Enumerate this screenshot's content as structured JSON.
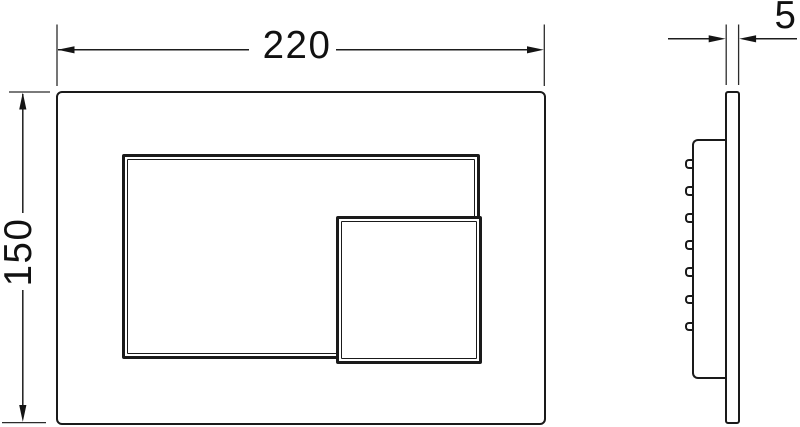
{
  "drawing": {
    "dimension_labels": {
      "width": "220",
      "height": "150",
      "thickness": "5"
    },
    "side_view": {
      "clip_count": 7
    },
    "colors": {
      "line": "#1a1a1a",
      "background": "#ffffff"
    }
  }
}
